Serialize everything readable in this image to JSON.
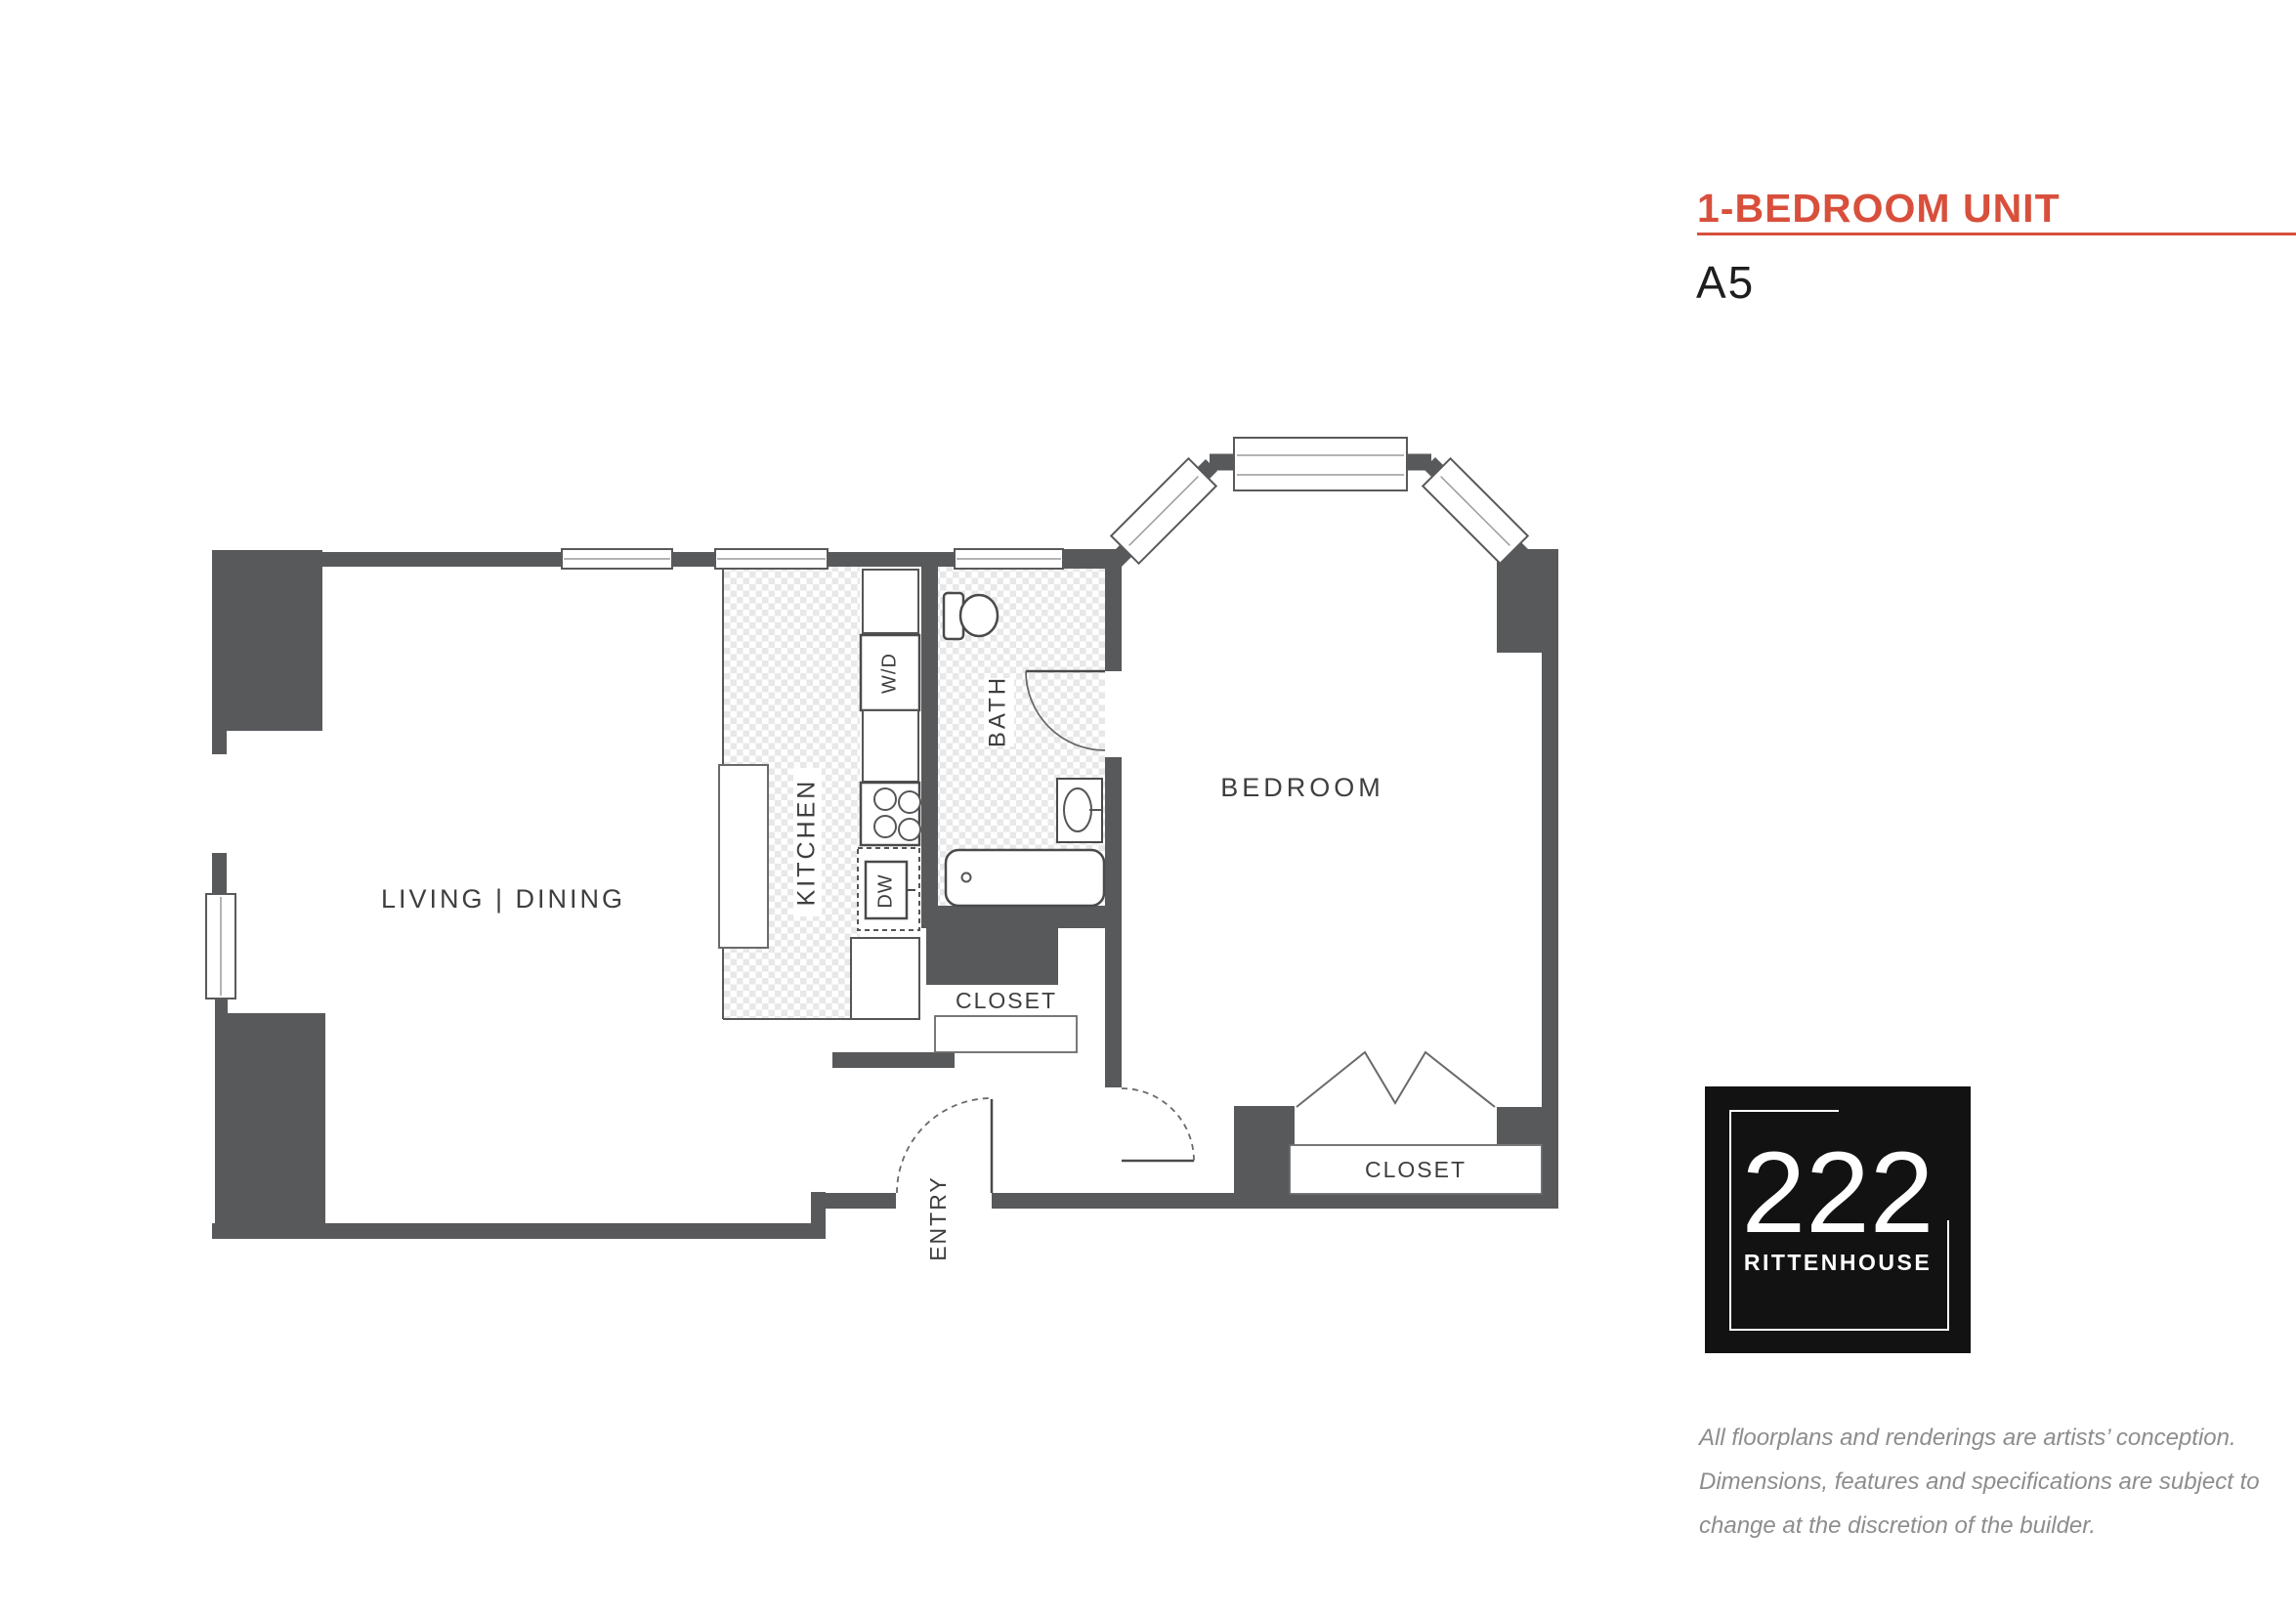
{
  "header": {
    "title": "1-BEDROOM UNIT",
    "unit_label": "A5",
    "accent_color": "#d84f3c"
  },
  "floorplan": {
    "wall_color": "#58595b",
    "rooms": {
      "living_dining": "LIVING | DINING",
      "kitchen": "KITCHEN",
      "bath": "BATH",
      "bedroom": "BEDROOM",
      "entry": "ENTRY",
      "hall_closet": "CLOSET",
      "bedroom_closet": "CLOSET"
    },
    "appliances": {
      "washer_dryer": "W/D",
      "dishwasher": "DW"
    }
  },
  "logo": {
    "number": "222",
    "name": "RITTENHOUSE"
  },
  "disclaimer": {
    "lines": [
      "All floorplans and renderings are artists’ conception.",
      "Dimensions, features and specifications are subject to",
      "change at the discretion of the builder."
    ]
  }
}
